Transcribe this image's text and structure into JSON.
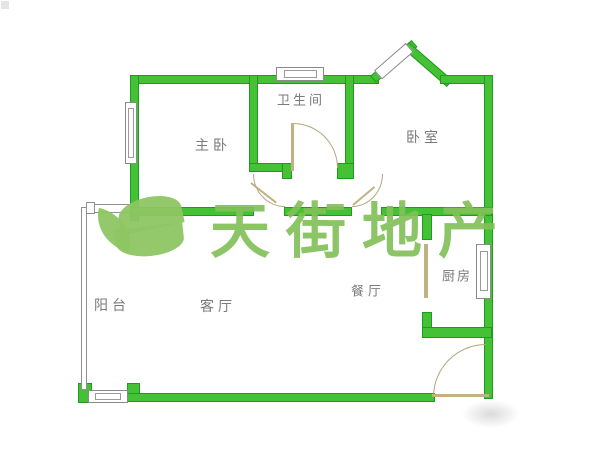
{
  "watermark_text": "天街地产",
  "rooms": [
    {
      "id": "master-bedroom",
      "label": "主卧"
    },
    {
      "id": "bathroom",
      "label": "卫生间"
    },
    {
      "id": "bedroom",
      "label": "卧室"
    },
    {
      "id": "balcony",
      "label": "阳台"
    },
    {
      "id": "living-room",
      "label": "客厅"
    },
    {
      "id": "dining-room",
      "label": "餐厅"
    },
    {
      "id": "kitchen",
      "label": "厨房"
    }
  ],
  "colors": {
    "wall_fill": "#45c135",
    "wall_border": "#1f9b1f",
    "watermark_green": "#8dc663",
    "label_gray": "#7a7a7a",
    "door_tan": "#c2b183",
    "background": "#ffffff"
  }
}
